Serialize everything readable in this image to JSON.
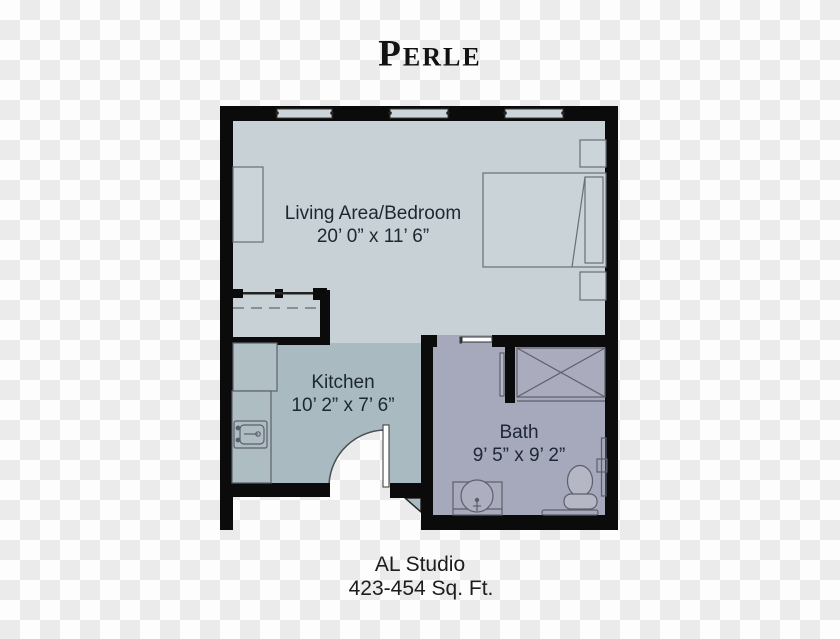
{
  "title": "Perle",
  "rooms": [
    {
      "name": "Living Area/Bedroom",
      "dimensions": "20’ 0” x 11’ 6”"
    },
    {
      "name": "Kitchen",
      "dimensions": "10’ 2” x 7’ 6”"
    },
    {
      "name": "Bath",
      "dimensions": "9’ 5” x 9’ 2”"
    }
  ],
  "footer": {
    "unit_type": "AL Studio",
    "area": "423-454 Sq. Ft."
  },
  "colors": {
    "living_floor": "#c7d1d6",
    "kitchen_floor": "#a9bbc0",
    "bath_floor": "#a6a8bb",
    "walls": "#0b0b0b",
    "fixture_outline": "#5d5f6b",
    "background_checker": "#ebebeb"
  }
}
